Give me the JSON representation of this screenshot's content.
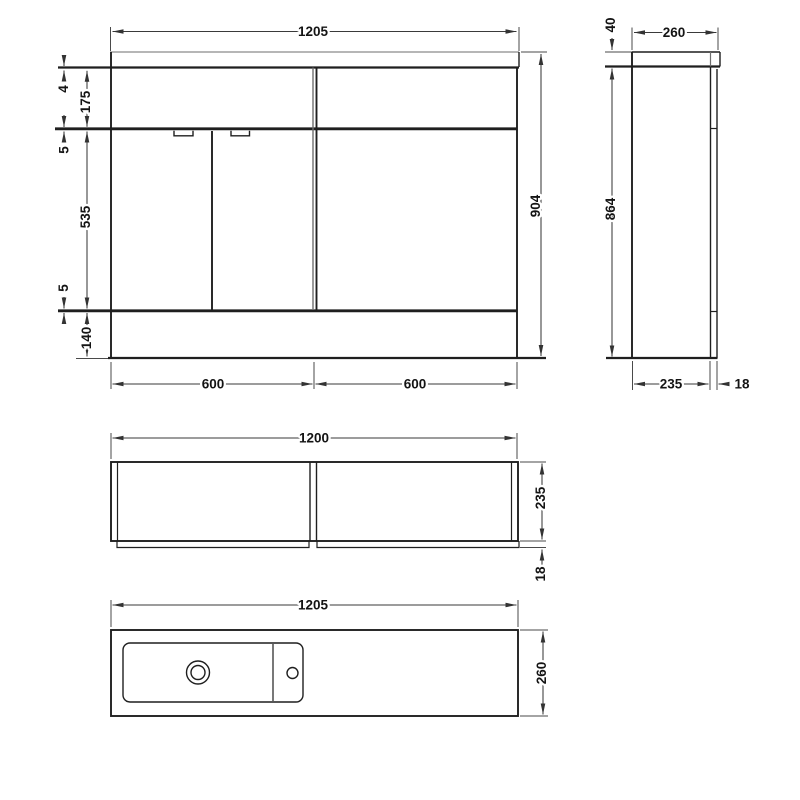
{
  "drawing": {
    "kind": "bathroom vanity combination unit technical drawing",
    "colors": {
      "background": "#ffffff",
      "main_line": "#1f1f1f",
      "dim_line": "#3a3a3a",
      "soft_line": "#8a8a8a",
      "label_text": "#141414"
    },
    "views": {
      "front": {
        "width": "1205",
        "worktop_gap": "4",
        "drawer_front_height": "175",
        "top_gap": "5",
        "door_height": "535",
        "bottom_gap": "5",
        "plinth_height": "140",
        "left_section_width": "600",
        "right_section_width": "600",
        "overall_height": "904"
      },
      "side": {
        "worktop_thickness": "40",
        "overall_depth": "260",
        "cabinet_height": "864",
        "cabinet_depth": "235",
        "door_thickness": "18"
      },
      "plan": {
        "width": "1200",
        "depth": "235",
        "front_panel_thickness": "18"
      },
      "basin": {
        "width": "1205",
        "depth": "260"
      }
    }
  }
}
